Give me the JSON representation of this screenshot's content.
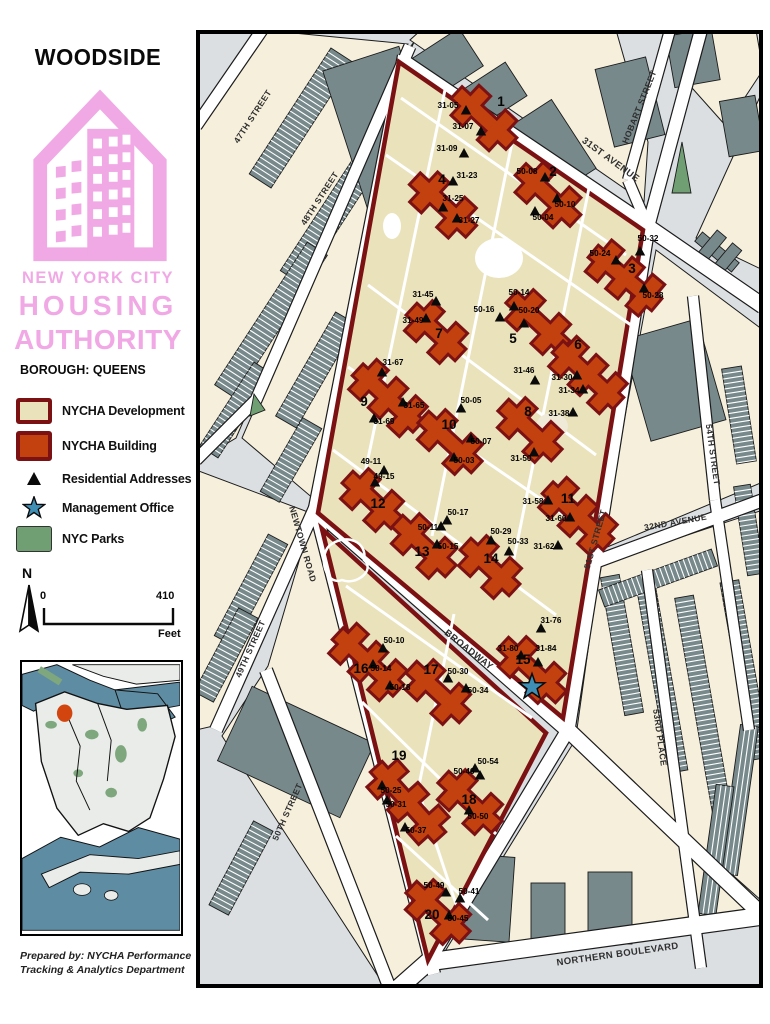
{
  "sidebar": {
    "title": "WOODSIDE",
    "org_lines": [
      "NEW YORK CITY",
      "HOUSING",
      "AUTHORITY"
    ],
    "borough": "BOROUGH: QUEENS",
    "legend": [
      {
        "id": "development",
        "label": "NYCHA Development",
        "swatch": "development"
      },
      {
        "id": "building",
        "label": "NYCHA Building",
        "swatch": "building"
      },
      {
        "id": "residential",
        "label": "Residential Addresses",
        "swatch": "triangle"
      },
      {
        "id": "office",
        "label": "Management Office",
        "swatch": "star"
      },
      {
        "id": "parks",
        "label": "NYC Parks",
        "swatch": "parks"
      }
    ],
    "compass": "N",
    "scale": {
      "start": "0",
      "end": "410",
      "unit": "Feet"
    },
    "prepared_by": [
      "Prepared by: NYCHA Performance",
      "Tracking & Analytics Department"
    ]
  },
  "colors": {
    "logo_pink": "#F0A9E5",
    "development_fill": "#E9E2BA",
    "development_border": "#7B1113",
    "building_fill": "#C2410E",
    "building_border": "#7B1113",
    "parks_fill": "#6F9F72",
    "star_fill": "#3F8FB5",
    "street_bg": "#DBDFE2",
    "block_fill": "#F5EFDC",
    "gray_building": "#78898B",
    "water": "#5E8CA3",
    "inset_land": "#E9ECE9",
    "marker": "#D3450F"
  },
  "map": {
    "streets": [
      {
        "name": "47TH STREET",
        "x": 59,
        "y": 88,
        "rot": -57,
        "size": 8.6
      },
      {
        "name": "48TH STREET",
        "x": 126,
        "y": 170,
        "rot": -57,
        "size": 8.6
      },
      {
        "name": "49TH STREET",
        "x": 57,
        "y": 620,
        "rot": -66,
        "size": 8.6
      },
      {
        "name": "50TH STREET",
        "x": 94,
        "y": 783,
        "rot": -66,
        "size": 8.6
      },
      {
        "name": "NEWTOWN ROAD",
        "x": 104,
        "y": 515,
        "rot": 74,
        "size": 8.6
      },
      {
        "name": "BROADWAY",
        "x": 271,
        "y": 622,
        "rot": 38,
        "size": 9.5
      },
      {
        "name": "NORTHERN BOULEVARD",
        "x": 422,
        "y": 927,
        "rot": -8,
        "size": 9.5
      },
      {
        "name": "31ST AVENUE",
        "x": 413,
        "y": 132,
        "rot": 36,
        "size": 9.5
      },
      {
        "name": "HOBART STREET",
        "x": 446,
        "y": 78,
        "rot": -68,
        "size": 8.6
      },
      {
        "name": "51ST STREET",
        "x": 402,
        "y": 510,
        "rot": -74,
        "size": 8.6
      },
      {
        "name": "54TH STREET",
        "x": 514,
        "y": 425,
        "rot": 82,
        "size": 8.6
      },
      {
        "name": "32ND AVENUE",
        "x": 480,
        "y": 495,
        "rot": -10,
        "size": 8.6
      },
      {
        "name": "53RD PLACE",
        "x": 461,
        "y": 708,
        "rot": 82,
        "size": 8.6
      }
    ],
    "buildings": [
      {
        "num": "1",
        "x": 288,
        "y": 88,
        "rot": 43,
        "len": 72,
        "nx": 305,
        "ny": 76,
        "addresses": [
          {
            "t": "31-05",
            "lx": 252,
            "ly": 78,
            "tx": 270,
            "ty": 81
          },
          {
            "t": "31-07",
            "lx": 267,
            "ly": 99,
            "tx": 285,
            "ty": 102
          },
          {
            "t": "31-09",
            "lx": 251,
            "ly": 121,
            "tx": 268,
            "ty": 124
          }
        ]
      },
      {
        "num": "2",
        "x": 352,
        "y": 165,
        "rot": 43,
        "len": 72,
        "nx": 357,
        "ny": 146,
        "addresses": [
          {
            "t": "50-08",
            "lx": 331,
            "ly": 144,
            "tx": 349,
            "ty": 148
          },
          {
            "t": "50-10",
            "lx": 369,
            "ly": 177,
            "tx": 361,
            "ty": 169
          },
          {
            "t": "50-04",
            "lx": 347,
            "ly": 190,
            "tx": 339,
            "ty": 182
          }
        ]
      },
      {
        "num": "3",
        "x": 429,
        "y": 248,
        "rot": 40,
        "len": 80,
        "nx": 436,
        "ny": 243,
        "addresses": [
          {
            "t": "50-24",
            "lx": 404,
            "ly": 226,
            "tx": 420,
            "ty": 231
          },
          {
            "t": "50-32",
            "lx": 452,
            "ly": 211,
            "tx": 444,
            "ty": 222
          },
          {
            "t": "50-28",
            "lx": 457,
            "ly": 268,
            "tx": 448,
            "ty": 259
          }
        ]
      },
      {
        "num": "4",
        "x": 247,
        "y": 175,
        "rot": 43,
        "len": 74,
        "nx": 246,
        "ny": 154,
        "addresses": [
          {
            "t": "31-23",
            "lx": 271,
            "ly": 148,
            "tx": 257,
            "ty": 152
          },
          {
            "t": "31-25",
            "lx": 257,
            "ly": 171,
            "tx": 247,
            "ty": 178
          },
          {
            "t": "31-27",
            "lx": 273,
            "ly": 193,
            "tx": 261,
            "ty": 189
          }
        ]
      },
      {
        "num": "5",
        "x": 342,
        "y": 292,
        "rot": 43,
        "len": 70,
        "nx": 317,
        "ny": 313,
        "addresses": [
          {
            "t": "50-14",
            "lx": 323,
            "ly": 265,
            "tx": 318,
            "ty": 277
          },
          {
            "t": "50-16",
            "lx": 288,
            "ly": 282,
            "tx": 304,
            "ty": 288
          },
          {
            "t": "50-20",
            "lx": 333,
            "ly": 283,
            "tx": 328,
            "ty": 294
          }
        ]
      },
      {
        "num": "6",
        "x": 392,
        "y": 345,
        "rot": 43,
        "len": 80,
        "nx": 382,
        "ny": 319,
        "addresses": [
          {
            "t": "31-30",
            "lx": 366,
            "ly": 350,
            "tx": 381,
            "ty": 346
          },
          {
            "t": "31-34",
            "lx": 373,
            "ly": 363,
            "tx": 387,
            "ty": 360
          },
          {
            "t": "31-38",
            "lx": 363,
            "ly": 386,
            "tx": 377,
            "ty": 383
          }
        ]
      },
      {
        "num": "7",
        "x": 240,
        "y": 302,
        "rot": 43,
        "len": 64,
        "nx": 243,
        "ny": 308,
        "addresses": [
          {
            "t": "31-45",
            "lx": 227,
            "ly": 267,
            "tx": 240,
            "ty": 272
          },
          {
            "t": "31-49",
            "lx": 217,
            "ly": 293,
            "tx": 230,
            "ty": 289
          }
        ]
      },
      {
        "num": "8",
        "x": 334,
        "y": 400,
        "rot": 43,
        "len": 70,
        "nx": 332,
        "ny": 386,
        "addresses": [
          {
            "t": "31-46",
            "lx": 328,
            "ly": 343,
            "tx": 339,
            "ty": 351
          },
          {
            "t": "31-50",
            "lx": 325,
            "ly": 431,
            "tx": 338,
            "ty": 423
          }
        ]
      },
      {
        "num": "9",
        "x": 192,
        "y": 368,
        "rot": 43,
        "len": 80,
        "nx": 168,
        "ny": 376,
        "addresses": [
          {
            "t": "31-67",
            "lx": 197,
            "ly": 335,
            "tx": 186,
            "ty": 343
          },
          {
            "t": "31-65",
            "lx": 218,
            "ly": 378,
            "tx": 207,
            "ty": 373
          },
          {
            "t": "31-69",
            "lx": 188,
            "ly": 394,
            "tx": 178,
            "ty": 389
          }
        ]
      },
      {
        "num": "10",
        "x": 254,
        "y": 412,
        "rot": 43,
        "len": 70,
        "nx": 253,
        "ny": 399,
        "addresses": [
          {
            "t": "50-05",
            "lx": 275,
            "ly": 373,
            "tx": 265,
            "ty": 379
          },
          {
            "t": "50-07",
            "lx": 285,
            "ly": 414,
            "tx": 275,
            "ty": 409
          },
          {
            "t": "50-03",
            "lx": 268,
            "ly": 433,
            "tx": 258,
            "ty": 428
          }
        ]
      },
      {
        "num": "11",
        "x": 382,
        "y": 486,
        "rot": 43,
        "len": 80,
        "nx": 372,
        "ny": 473,
        "addresses": [
          {
            "t": "31-58",
            "lx": 337,
            "ly": 474,
            "tx": 352,
            "ty": 471
          },
          {
            "t": "31-60",
            "lx": 360,
            "ly": 491,
            "tx": 374,
            "ty": 488
          },
          {
            "t": "31-62",
            "lx": 348,
            "ly": 519,
            "tx": 362,
            "ty": 516
          }
        ]
      },
      {
        "num": "12",
        "x": 176,
        "y": 470,
        "rot": 43,
        "len": 64,
        "nx": 182,
        "ny": 478,
        "addresses": [
          {
            "t": "49-11",
            "lx": 175,
            "ly": 434,
            "tx": 188,
            "ty": 441
          },
          {
            "t": "49-15",
            "lx": 188,
            "ly": 449,
            "tx": 179,
            "ty": 453
          }
        ]
      },
      {
        "num": "13",
        "x": 228,
        "y": 516,
        "rot": 43,
        "len": 70,
        "nx": 226,
        "ny": 526,
        "addresses": [
          {
            "t": "50-17",
            "lx": 262,
            "ly": 485,
            "tx": 251,
            "ty": 491
          },
          {
            "t": "50-11",
            "lx": 232,
            "ly": 500,
            "tx": 245,
            "ty": 497
          },
          {
            "t": "50-15",
            "lx": 252,
            "ly": 519,
            "tx": 241,
            "ty": 515
          }
        ]
      },
      {
        "num": "14",
        "x": 294,
        "y": 537,
        "rot": 43,
        "len": 64,
        "nx": 295,
        "ny": 533,
        "addresses": [
          {
            "t": "50-29",
            "lx": 305,
            "ly": 504,
            "tx": 295,
            "ty": 511
          },
          {
            "t": "50-33",
            "lx": 322,
            "ly": 514,
            "tx": 313,
            "ty": 522
          }
        ]
      },
      {
        "num": "15",
        "x": 336,
        "y": 640,
        "rot": 43,
        "len": 76,
        "nx": 327,
        "ny": 634,
        "addresses": [
          {
            "t": "31-76",
            "lx": 355,
            "ly": 593,
            "tx": 345,
            "ty": 599
          },
          {
            "t": "31-80",
            "lx": 312,
            "ly": 621,
            "tx": 325,
            "ty": 626
          },
          {
            "t": "31-84",
            "lx": 350,
            "ly": 621,
            "tx": 342,
            "ty": 633
          }
        ]
      },
      {
        "num": "16",
        "x": 172,
        "y": 632,
        "rot": 43,
        "len": 80,
        "nx": 165,
        "ny": 643,
        "addresses": [
          {
            "t": "50-10",
            "lx": 198,
            "ly": 613,
            "tx": 187,
            "ty": 619
          },
          {
            "t": "50-14",
            "lx": 185,
            "ly": 641,
            "tx": 177,
            "ty": 635
          },
          {
            "t": "50-18",
            "lx": 204,
            "ly": 660,
            "tx": 194,
            "ty": 656
          }
        ]
      },
      {
        "num": "17",
        "x": 242,
        "y": 662,
        "rot": 43,
        "len": 70,
        "nx": 235,
        "ny": 644,
        "addresses": [
          {
            "t": "50-30",
            "lx": 262,
            "ly": 644,
            "tx": 252,
            "ty": 649
          },
          {
            "t": "50-34",
            "lx": 282,
            "ly": 663,
            "tx": 270,
            "ty": 659
          }
        ]
      },
      {
        "num": "18",
        "x": 274,
        "y": 772,
        "rot": 43,
        "len": 70,
        "nx": 273,
        "ny": 774,
        "addresses": [
          {
            "t": "50-46",
            "lx": 268,
            "ly": 744,
            "tx": 279,
            "ty": 739
          },
          {
            "t": "50-54",
            "lx": 292,
            "ly": 734,
            "tx": 284,
            "ty": 746
          },
          {
            "t": "50-50",
            "lx": 282,
            "ly": 789,
            "tx": 273,
            "ty": 781
          }
        ]
      },
      {
        "num": "19",
        "x": 212,
        "y": 772,
        "rot": 48,
        "len": 92,
        "nx": 203,
        "ny": 730,
        "addresses": [
          {
            "t": "50-25",
            "lx": 195,
            "ly": 763,
            "tx": 186,
            "ty": 756
          },
          {
            "t": "50-31",
            "lx": 200,
            "ly": 777,
            "tx": 191,
            "ty": 771
          },
          {
            "t": "50-37",
            "lx": 220,
            "ly": 803,
            "tx": 209,
            "ty": 798
          }
        ]
      },
      {
        "num": "20",
        "x": 242,
        "y": 882,
        "rot": 43,
        "len": 70,
        "nx": 236,
        "ny": 889,
        "addresses": [
          {
            "t": "50-49",
            "lx": 238,
            "ly": 858,
            "tx": 250,
            "ty": 863
          },
          {
            "t": "50-41",
            "lx": 273,
            "ly": 864,
            "tx": 264,
            "ty": 869
          },
          {
            "t": "50-45",
            "lx": 262,
            "ly": 891,
            "tx": 253,
            "ty": 886
          }
        ]
      }
    ],
    "management_office": {
      "x": 336,
      "y": 657,
      "building": "15"
    }
  }
}
